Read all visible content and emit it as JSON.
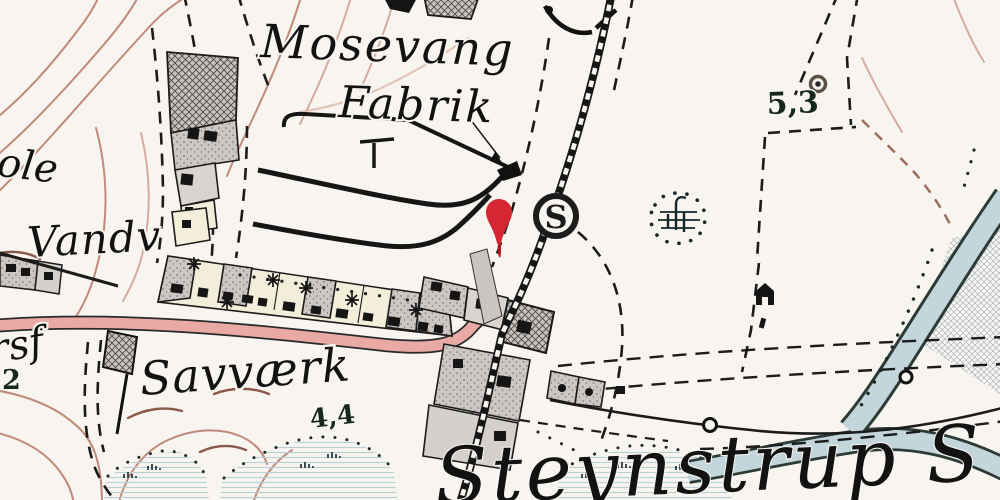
{
  "labels": {
    "mosevang": "Mosevang",
    "fabrik": "Fabrik",
    "skole_partial": "ole",
    "vandvaerk_partial": "Vandv",
    "rsf_partial": "rsf",
    "num_partial": "2",
    "savvaerk": "Savværk",
    "steynstrup": "Steynstrup S",
    "spot_height_44": "4,4",
    "spot_height_53": "5,3"
  },
  "station": {
    "symbol": "S"
  },
  "marker": {
    "color": "#d42733"
  },
  "colors": {
    "road": "#e9a9a4",
    "water": "#c3d6dc",
    "contour": "#c08979",
    "ink": "#1b1b1b"
  }
}
